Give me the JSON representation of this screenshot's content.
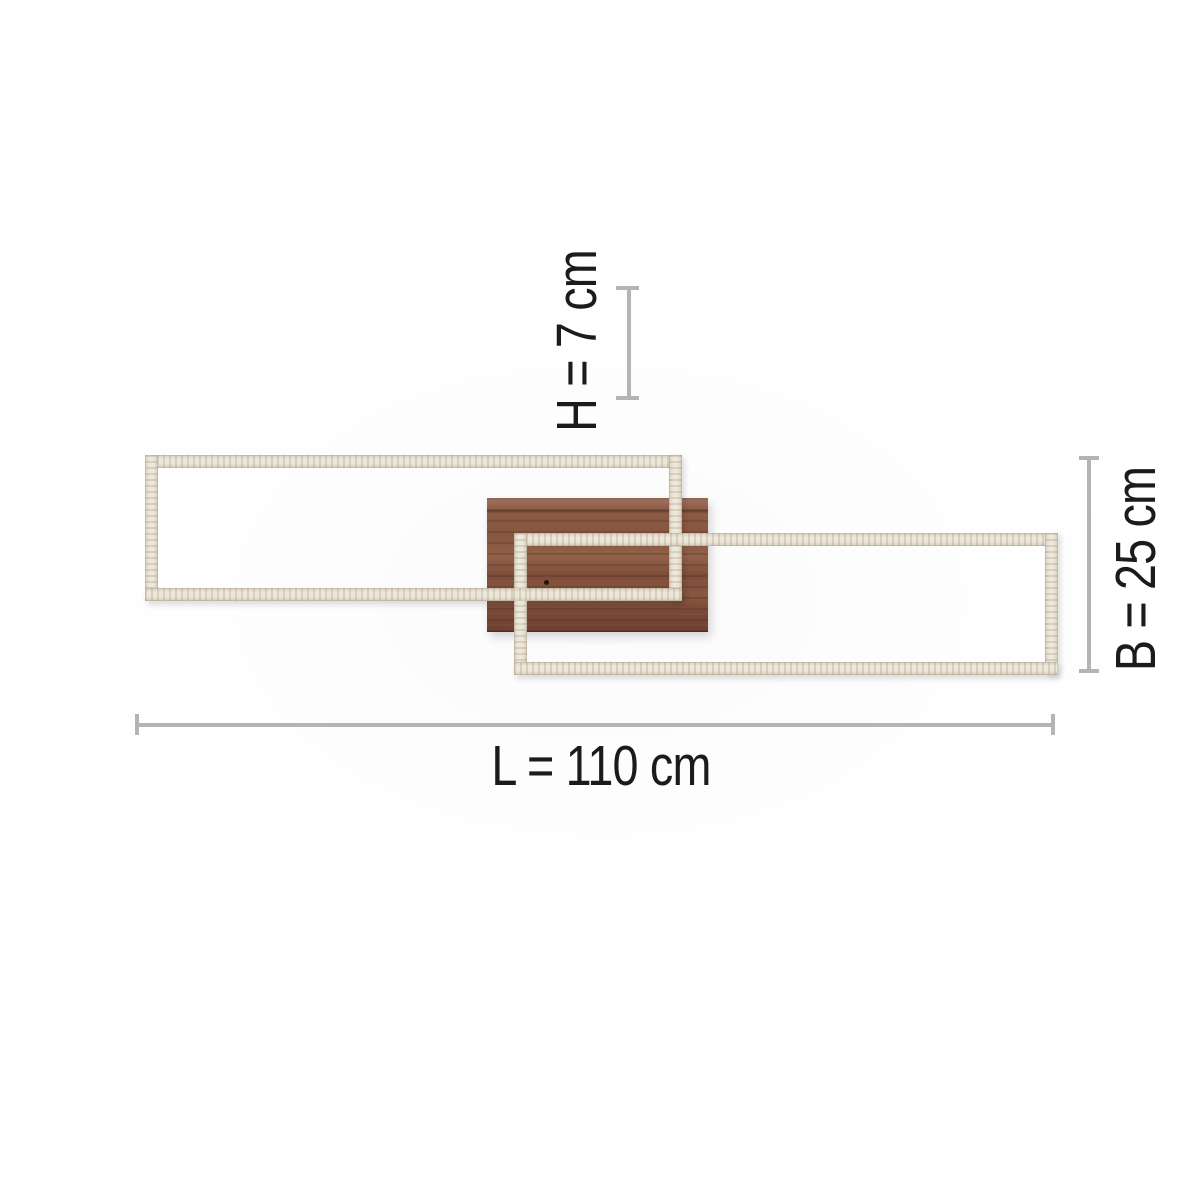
{
  "diagram": {
    "type": "ceiling-light-dimension-diagram",
    "labels": {
      "height": "H = 7 cm",
      "width": "B = 25 cm",
      "length": "L = 110 cm"
    },
    "parts": {
      "left_frame": "led-light-frame",
      "right_frame": "led-light-frame",
      "canopy": "wood-mount",
      "sensor": "sensor-dot"
    },
    "colors": {
      "frame": "#ece6d8",
      "frame_edge": "#d3cab8",
      "wood": "#875640",
      "dimension_line": "#b4b4b4",
      "text": "#1b1b1b",
      "background": "#ffffff"
    }
  }
}
